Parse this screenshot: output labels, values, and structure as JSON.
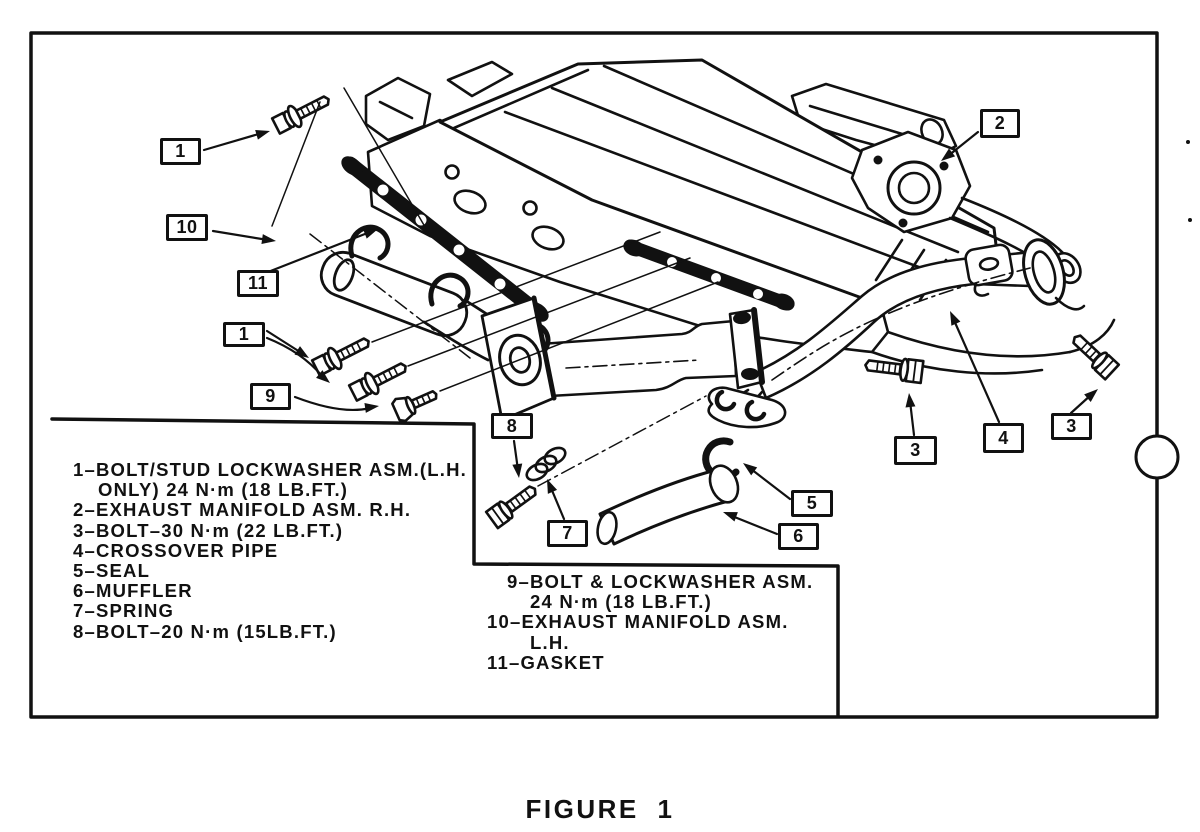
{
  "figure": {
    "caption": "FIGURE 1"
  },
  "colors": {
    "ink": "#111111",
    "paper": "#ffffff"
  },
  "callouts": {
    "one_top": "1",
    "ten": "10",
    "eleven": "11",
    "one_left": "1",
    "nine": "9",
    "eight": "8",
    "seven": "7",
    "five": "5",
    "six": "6",
    "two": "2",
    "three_left": "3",
    "four": "4",
    "three_right": "3"
  },
  "legend_left": {
    "lines": [
      "1–BOLT/STUD LOCKWASHER ASM.(L.H.",
      "ONLY) 24 N·m (18 LB.FT.)",
      "2–EXHAUST MANIFOLD ASM. R.H.",
      "3–BOLT–30 N·m (22 LB.FT.)",
      "4–CROSSOVER PIPE",
      "5–SEAL",
      "6–MUFFLER",
      "7–SPRING",
      "8–BOLT–20 N·m (15LB.FT.)"
    ]
  },
  "legend_right": {
    "lines": [
      "9–BOLT & LOCKWASHER ASM.",
      "24 N·m (18 LB.FT.)",
      "10–EXHAUST MANIFOLD ASM.",
      "L.H.",
      "11–GASKET"
    ]
  }
}
